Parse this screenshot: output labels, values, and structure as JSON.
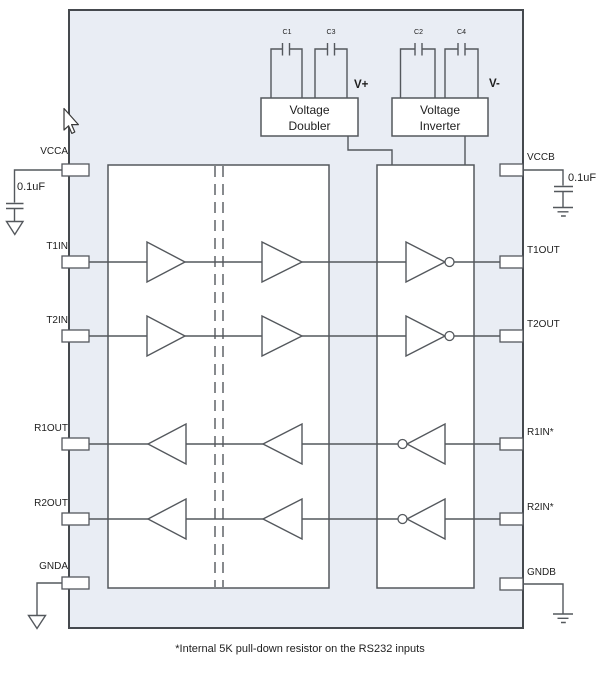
{
  "colors": {
    "page-bg": "#ffffff",
    "chip-fill": "#e9edf4",
    "chip-stroke": "#45494e",
    "line-color": "#54585d",
    "box-fill": "#ffffff",
    "text-color": "#1e1e1e"
  },
  "pins_left": [
    {
      "label": "VCCA"
    },
    {
      "label": "T1IN"
    },
    {
      "label": "T2IN"
    },
    {
      "label": "R1OUT"
    },
    {
      "label": "R2OUT"
    },
    {
      "label": "GNDA"
    }
  ],
  "pins_right": [
    {
      "label": "VCCB"
    },
    {
      "label": "T1OUT"
    },
    {
      "label": "T2OUT"
    },
    {
      "label": "R1IN*"
    },
    {
      "label": "R2IN*"
    },
    {
      "label": "GNDB"
    }
  ],
  "blocks": {
    "voltage_doubler": "Voltage\nDoubler",
    "voltage_inverter": "Voltage\nInverter"
  },
  "capacitors": {
    "c1": "C1",
    "c3": "C3",
    "c2": "C2",
    "c4": "C4"
  },
  "rails": {
    "v_plus": "V+",
    "v_minus": "V-"
  },
  "decoupling_caps": {
    "left": "0.1uF",
    "right": "0.1uF"
  },
  "note": "*Internal 5K pull-down resistor on the RS232 inputs"
}
